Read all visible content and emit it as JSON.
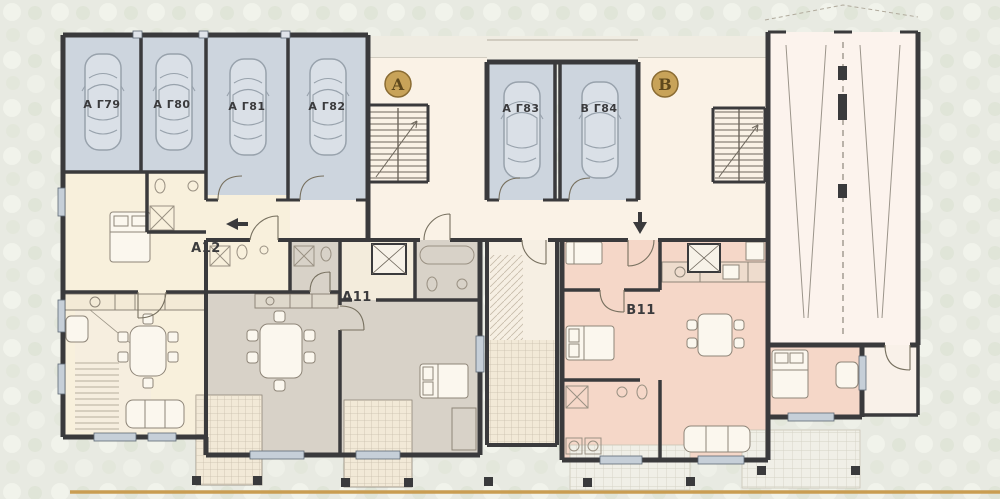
{
  "drawing": {
    "type": "architectural-floor-plan",
    "description": "Ground floor plan with garages, two entrances, three apartments and car ramp"
  },
  "garages": {
    "bays": [
      {
        "id": "g79",
        "label": "A Г79"
      },
      {
        "id": "g80",
        "label": "A Г80"
      },
      {
        "id": "g81",
        "label": "A Г81"
      },
      {
        "id": "g82",
        "label": "A Г82"
      },
      {
        "id": "g83",
        "label": "A Г83"
      },
      {
        "id": "g84",
        "label": "B Г84"
      }
    ]
  },
  "apartments": [
    {
      "id": "a12",
      "label": "A12"
    },
    {
      "id": "a11",
      "label": "A11"
    },
    {
      "id": "b11",
      "label": "B11"
    }
  ],
  "entrances": [
    {
      "id": "entrance-a",
      "label": "A"
    },
    {
      "id": "entrance-b",
      "label": "B"
    }
  ],
  "colors": {
    "background": "#e8eae2",
    "garage_fill": "#cdd5de",
    "corridor_fill": "#faf2e6",
    "apartment_a12_fill": "#f8f0dc",
    "apartment_a11_fill": "#d8d2c8",
    "apartment_b11_fill": "#f5d7c8",
    "ramp_fill": "#fcf3ed",
    "wall": "#3a3a3c",
    "badge_gold": "#c8a359",
    "site_line_gold": "#c99d52"
  }
}
